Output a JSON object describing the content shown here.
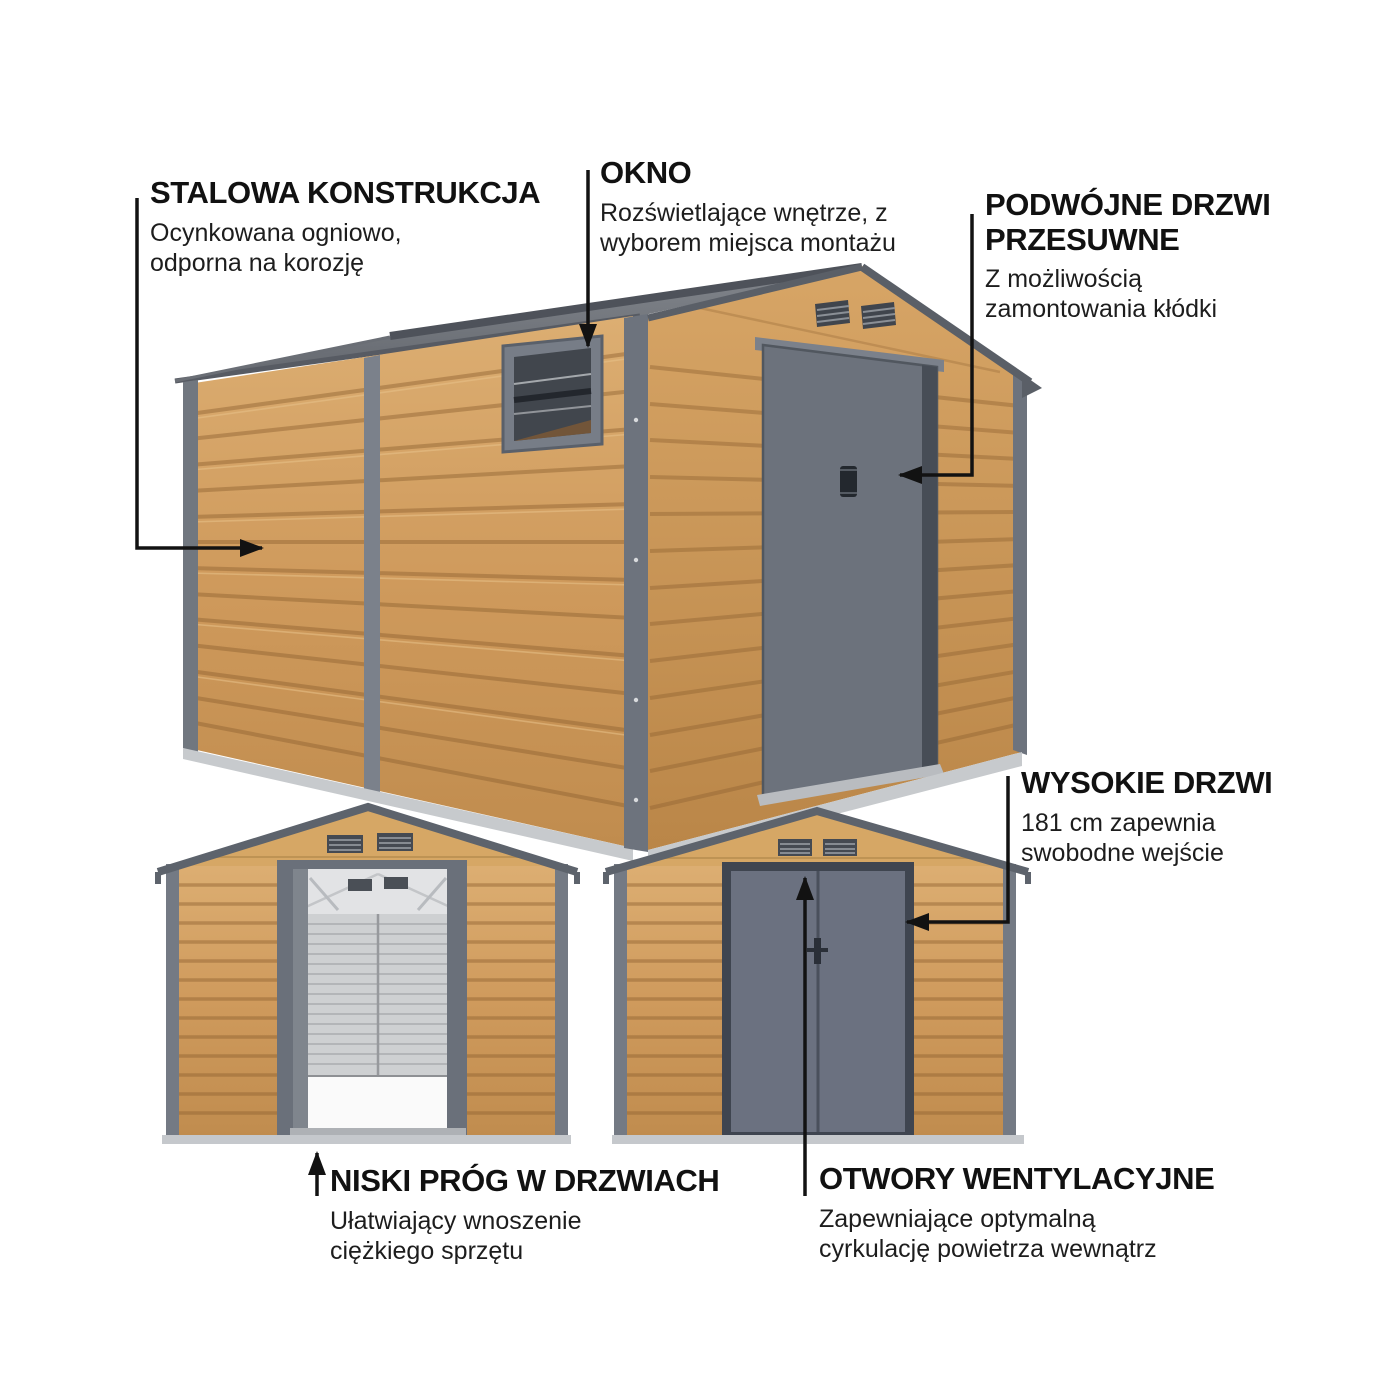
{
  "page": {
    "type": "product-feature-infographic",
    "subject": "garden shed with wood-look steel panels",
    "background": "#ffffff",
    "views": [
      "isometric-shed",
      "front-view-doors-open",
      "front-view-doors-closed"
    ]
  },
  "colors": {
    "wood": "#cf9a5c",
    "wood_light": "#dcae72",
    "wood_dark": "#8f6231",
    "roof_gray": "#6e7379",
    "trim_gray": "#6d737d",
    "door_gray": "#6b7180",
    "frame_dark": "#3f4550",
    "vent_dark": "#454a52",
    "interior_light": "#ced0d2",
    "floor_white": "#fafafa",
    "arrow": "#121212",
    "text": "#111111"
  },
  "annotations": [
    {
      "id": "stalowa-konstrukcja",
      "heading_lines": [
        "STALOWA KONSTRUKCJA"
      ],
      "body_lines": [
        "Ocynkowana ogniowo,",
        "odporna na korozję"
      ]
    },
    {
      "id": "okno",
      "heading_lines": [
        "OKNO"
      ],
      "body_lines": [
        "Rozświetlające wnętrze, z",
        "wyborem miejsca montażu"
      ]
    },
    {
      "id": "podwojne-drzwi-przesuwne",
      "heading_lines": [
        "PODWÓJNE DRZWI",
        "PRZESUWNE"
      ],
      "body_lines": [
        "Z możliwością",
        "zamontowania kłódki"
      ]
    },
    {
      "id": "wysokie-drzwi",
      "heading_lines": [
        "WYSOKIE DRZWI"
      ],
      "body_lines": [
        "181 cm zapewnia",
        "swobodne wejście"
      ]
    },
    {
      "id": "niski-prog-w-drzwiach",
      "heading_lines": [
        "NISKI PRÓG W DRZWIACH"
      ],
      "body_lines": [
        "Ułatwiający wnoszenie",
        "ciężkiego sprzętu"
      ]
    },
    {
      "id": "otwory-wentylacyjne",
      "heading_lines": [
        "OTWORY WENTYLACYJNE"
      ],
      "body_lines": [
        "Zapewniające optymalną",
        "cyrkulację powietrza wewnątrz"
      ]
    }
  ]
}
